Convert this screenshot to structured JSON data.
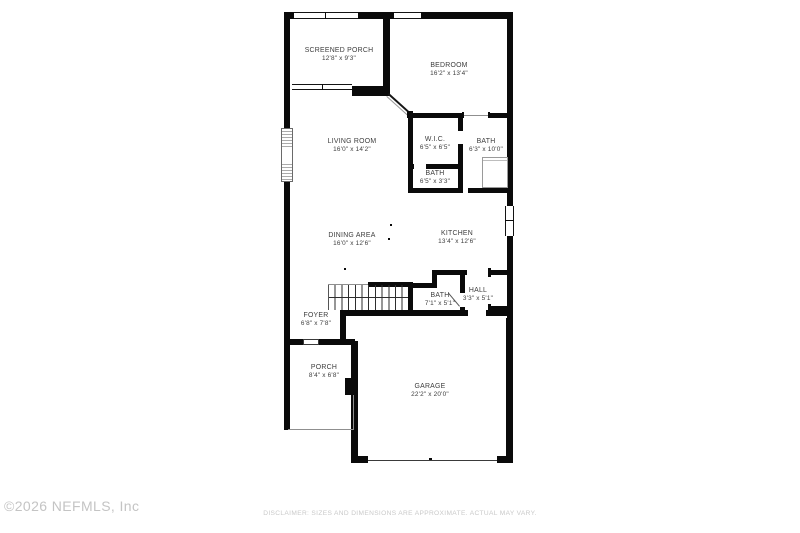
{
  "rooms": [
    {
      "name": "SCREENED PORCH",
      "dims": "12'8\" x 9'3\""
    },
    {
      "name": "BEDROOM",
      "dims": "16'2\" x 13'4\""
    },
    {
      "name": "LIVING ROOM",
      "dims": "16'0\" x 14'2\""
    },
    {
      "name": "W.I.C.",
      "dims": "6'5\" x 6'5\""
    },
    {
      "name": "BATH",
      "dims": "6'3\" x 10'0\""
    },
    {
      "name": "BATH",
      "dims": "6'5\" x 3'3\""
    },
    {
      "name": "DINING AREA",
      "dims": "16'0\" x 12'6\""
    },
    {
      "name": "KITCHEN",
      "dims": "13'4\" x 12'6\""
    },
    {
      "name": "BATH",
      "dims": "7'1\" x 5'1\""
    },
    {
      "name": "HALL",
      "dims": "3'3\" x 5'1\""
    },
    {
      "name": "FOYER",
      "dims": "6'8\" x 7'8\""
    },
    {
      "name": "PORCH",
      "dims": "8'4\" x 6'8\""
    },
    {
      "name": "GARAGE",
      "dims": "22'2\" x 20'0\""
    }
  ],
  "footer": {
    "copyright": "©2026 NEFMLS, Inc",
    "disclaimer": "DISCLAIMER: SIZES AND DIMENSIONS ARE APPROXIMATE. ACTUAL MAY VARY."
  },
  "colors": {
    "wall": "#0a0a0a",
    "label_text": "#3d3d3d",
    "footer_text": "#c5c5c5",
    "background": "#ffffff"
  }
}
